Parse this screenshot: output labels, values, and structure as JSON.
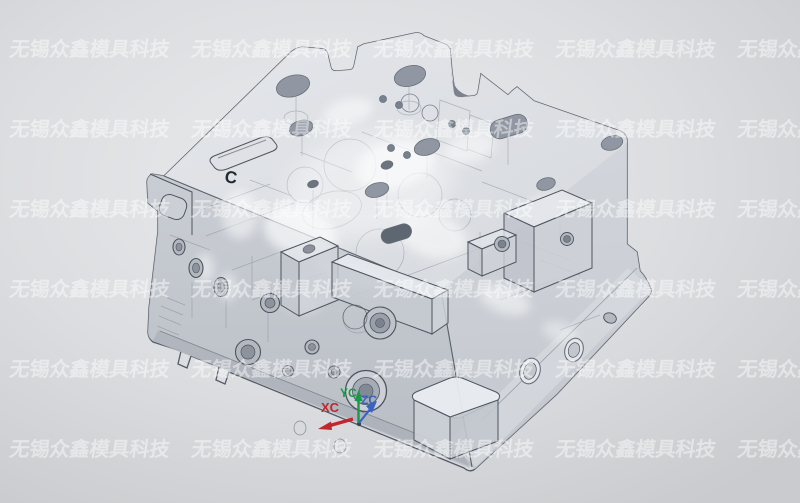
{
  "viewport": {
    "model_semantic": "translucent-mold-base-3d-model",
    "background_center": "#eaebed",
    "background_edge": "#c9cbce"
  },
  "watermark": {
    "text": "无锡众鑫模具科技",
    "color": "rgba(255,255,255,0.45)"
  },
  "triad": {
    "x_label": "XC",
    "y_label": "YC",
    "z_label": "ZC",
    "x_color": "#c1272d",
    "y_color": "#1a9948",
    "z_color": "#3a62c4"
  },
  "marks": {
    "c_label": "C",
    "c_color": "#232934"
  }
}
